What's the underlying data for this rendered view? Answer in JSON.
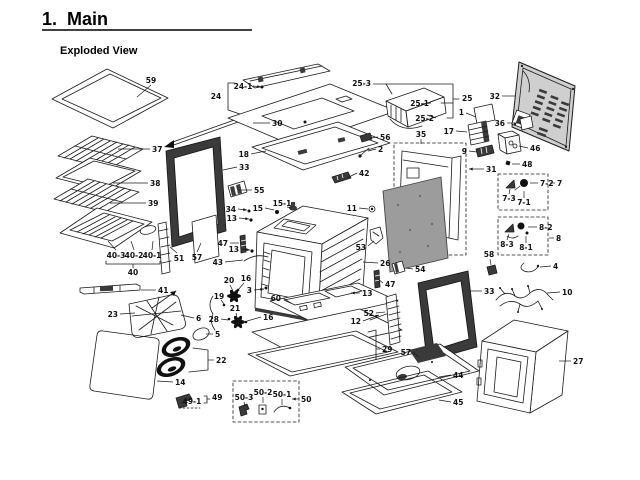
{
  "page": {
    "title": "1.  Main",
    "subtitle": "Exploded View"
  },
  "colors": {
    "ink": "#1a1a1a",
    "paper": "#ffffff",
    "panel_gray": "#cfcfcf",
    "insulation_gray": "#9c9c9c",
    "dark_fill": "#3a3a3a"
  },
  "diagram": {
    "labels": [
      {
        "t": "59",
        "x": 151,
        "y": 83,
        "a": "m",
        "line": [
          151,
          85,
          137,
          97
        ]
      },
      {
        "t": "37",
        "x": 152,
        "y": 152,
        "a": "s",
        "line": [
          150,
          149,
          118,
          149
        ]
      },
      {
        "t": "38",
        "x": 150,
        "y": 186,
        "a": "s",
        "line": [
          148,
          183,
          113,
          183
        ]
      },
      {
        "t": "39",
        "x": 148,
        "y": 206,
        "a": "s",
        "line": [
          146,
          203,
          110,
          203
        ]
      },
      {
        "t": "40-3",
        "x": 116,
        "y": 258,
        "a": "m",
        "line": [
          116,
          250,
          108,
          241
        ]
      },
      {
        "t": "40-2",
        "x": 134,
        "y": 258,
        "a": "m",
        "line": [
          134,
          250,
          131,
          241
        ]
      },
      {
        "t": "40-1",
        "x": 152,
        "y": 258,
        "a": "m",
        "line": [
          152,
          250,
          153,
          241
        ]
      },
      {
        "t": "40",
        "x": 133,
        "y": 275,
        "a": "m"
      },
      {
        "t": "51",
        "x": 179,
        "y": 261,
        "a": "m",
        "line": [
          177,
          253,
          170,
          247
        ]
      },
      {
        "t": "57",
        "x": 197,
        "y": 260,
        "a": "m",
        "line": [
          197,
          252,
          201,
          243
        ]
      },
      {
        "t": "41",
        "x": 158,
        "y": 293,
        "a": "s",
        "line": [
          156,
          290,
          141,
          290
        ]
      },
      {
        "t": "23",
        "x": 118,
        "y": 317,
        "a": "e",
        "line": [
          120,
          314,
          135,
          313
        ]
      },
      {
        "t": "6",
        "x": 196,
        "y": 321,
        "a": "s",
        "line": [
          194,
          318,
          181,
          315
        ]
      },
      {
        "t": "5",
        "x": 215,
        "y": 337,
        "a": "s",
        "line": [
          213,
          334,
          206,
          334
        ]
      },
      {
        "t": "22",
        "x": 216,
        "y": 363,
        "a": "s",
        "line": [
          214,
          360,
          208,
          360
        ]
      },
      {
        "t": "14",
        "x": 175,
        "y": 385,
        "a": "s",
        "line": [
          173,
          382,
          157,
          381
        ]
      },
      {
        "t": "49-1",
        "x": 192,
        "y": 404,
        "a": "m",
        "line": [
          186,
          400,
          181,
          404
        ]
      },
      {
        "t": "49",
        "x": 212,
        "y": 400,
        "a": "s"
      },
      {
        "t": "24-1",
        "x": 243,
        "y": 89,
        "a": "m",
        "line": [
          253,
          86,
          261,
          87
        ],
        "arrow": true
      },
      {
        "t": "24",
        "x": 216,
        "y": 99,
        "a": "m"
      },
      {
        "t": "30",
        "x": 272,
        "y": 126,
        "a": "s",
        "line": [
          270,
          123,
          253,
          123
        ]
      },
      {
        "t": "18",
        "x": 249,
        "y": 157,
        "a": "e",
        "line": [
          251,
          154,
          266,
          151
        ]
      },
      {
        "t": "33",
        "x": 239,
        "y": 170,
        "a": "s",
        "line": [
          237,
          167,
          223,
          170
        ]
      },
      {
        "t": "55",
        "x": 254,
        "y": 193,
        "a": "s",
        "line": [
          252,
          190,
          241,
          190
        ]
      },
      {
        "t": "34",
        "x": 236,
        "y": 212,
        "a": "e",
        "line": [
          238,
          209,
          247,
          210
        ],
        "arrow": true
      },
      {
        "t": "15",
        "x": 263,
        "y": 211,
        "a": "e",
        "line": [
          265,
          208,
          274,
          210
        ]
      },
      {
        "t": "15-1",
        "x": 282,
        "y": 206,
        "a": "m",
        "line": [
          287,
          207,
          292,
          208
        ]
      },
      {
        "t": "13",
        "x": 237,
        "y": 221,
        "a": "e",
        "line": [
          239,
          218,
          249,
          219
        ],
        "arrow": true
      },
      {
        "t": "47",
        "x": 228,
        "y": 246,
        "a": "e",
        "line": [
          230,
          243,
          239,
          243
        ]
      },
      {
        "t": "13",
        "x": 239,
        "y": 252,
        "a": "e",
        "line": [
          241,
          249,
          250,
          250
        ],
        "arrow": true
      },
      {
        "t": "43",
        "x": 223,
        "y": 265,
        "a": "e",
        "line": [
          225,
          262,
          243,
          260
        ]
      },
      {
        "t": "11",
        "x": 357,
        "y": 211,
        "a": "e",
        "line": [
          359,
          208,
          368,
          209
        ]
      },
      {
        "t": "53",
        "x": 366,
        "y": 250,
        "a": "e",
        "line": [
          368,
          246,
          374,
          241
        ]
      },
      {
        "t": "26",
        "x": 380,
        "y": 266,
        "a": "s",
        "line": [
          378,
          263,
          363,
          262
        ]
      },
      {
        "t": "54",
        "x": 415,
        "y": 272,
        "a": "s",
        "line": [
          413,
          269,
          406,
          268
        ]
      },
      {
        "t": "47",
        "x": 385,
        "y": 287,
        "a": "s",
        "line": [
          383,
          283,
          378,
          279
        ]
      },
      {
        "t": "13",
        "x": 362,
        "y": 296,
        "a": "s",
        "line": [
          360,
          293,
          351,
          293
        ],
        "arrow": true
      },
      {
        "t": "3",
        "x": 252,
        "y": 293,
        "a": "e",
        "line": [
          254,
          290,
          264,
          289
        ],
        "arrow": true
      },
      {
        "t": "20",
        "x": 229,
        "y": 283,
        "a": "m",
        "line": [
          230,
          285,
          233,
          291
        ]
      },
      {
        "t": "16",
        "x": 246,
        "y": 281,
        "a": "m",
        "line": [
          244,
          283,
          238,
          290
        ]
      },
      {
        "t": "19",
        "x": 219,
        "y": 299,
        "a": "m",
        "line": [
          221,
          300,
          224,
          304
        ]
      },
      {
        "t": "28",
        "x": 219,
        "y": 322,
        "a": "e",
        "line": [
          221,
          319,
          228,
          320
        ]
      },
      {
        "t": "21",
        "x": 235,
        "y": 311,
        "a": "m",
        "line": [
          236,
          313,
          237,
          318
        ]
      },
      {
        "t": "16",
        "x": 263,
        "y": 320,
        "a": "s",
        "line": [
          261,
          317,
          247,
          321
        ]
      },
      {
        "t": "60",
        "x": 281,
        "y": 301,
        "a": "e",
        "line": [
          283,
          298,
          291,
          303
        ]
      },
      {
        "t": "52",
        "x": 374,
        "y": 316,
        "a": "e",
        "line": [
          376,
          313,
          385,
          312
        ]
      },
      {
        "t": "12",
        "x": 361,
        "y": 324,
        "a": "e",
        "line": [
          363,
          321,
          379,
          315
        ],
        "arrow": true
      },
      {
        "t": "29",
        "x": 382,
        "y": 352,
        "a": "s",
        "line": [
          380,
          349,
          376,
          349
        ]
      },
      {
        "t": "50-3",
        "x": 244,
        "y": 400,
        "a": "m",
        "line": [
          244,
          402,
          245,
          406
        ]
      },
      {
        "t": "50-2",
        "x": 263,
        "y": 395,
        "a": "m",
        "line": [
          263,
          397,
          263,
          403
        ]
      },
      {
        "t": "50-1",
        "x": 282,
        "y": 397,
        "a": "m",
        "line": [
          282,
          399,
          282,
          405
        ]
      },
      {
        "t": "50",
        "x": 301,
        "y": 402,
        "a": "s",
        "line": [
          299,
          399,
          292,
          399
        ],
        "arrow": true
      },
      {
        "t": "42",
        "x": 359,
        "y": 176,
        "a": "s",
        "line": [
          357,
          173,
          347,
          178
        ]
      },
      {
        "t": "56",
        "x": 380,
        "y": 140,
        "a": "s",
        "line": [
          378,
          137,
          370,
          138
        ]
      },
      {
        "t": "2",
        "x": 378,
        "y": 152,
        "a": "s",
        "line": [
          376,
          149,
          368,
          151
        ]
      },
      {
        "t": "25-3",
        "x": 371,
        "y": 86,
        "a": "e",
        "line": [
          373,
          84,
          386,
          84
        ]
      },
      {
        "t": "25-1",
        "x": 429,
        "y": 106,
        "a": "e",
        "line": [
          431,
          103,
          421,
          104
        ]
      },
      {
        "t": "25",
        "x": 462,
        "y": 101,
        "a": "s"
      },
      {
        "t": "25-2",
        "x": 434,
        "y": 121,
        "a": "e",
        "line": [
          436,
          118,
          427,
          115
        ]
      },
      {
        "t": "1",
        "x": 464,
        "y": 115,
        "a": "e",
        "line": [
          466,
          113,
          476,
          117
        ]
      },
      {
        "t": "17",
        "x": 454,
        "y": 134,
        "a": "e",
        "line": [
          456,
          131,
          467,
          132
        ]
      },
      {
        "t": "9",
        "x": 467,
        "y": 154,
        "a": "e",
        "line": [
          469,
          151,
          477,
          152
        ]
      },
      {
        "t": "31",
        "x": 486,
        "y": 172,
        "a": "s",
        "line": [
          484,
          169,
          469,
          169
        ],
        "arrow": true
      },
      {
        "t": "35",
        "x": 421,
        "y": 137,
        "a": "m",
        "line": [
          421,
          139,
          421,
          144
        ]
      },
      {
        "t": "32",
        "x": 500,
        "y": 99,
        "a": "e",
        "line": [
          502,
          96,
          515,
          96
        ]
      },
      {
        "t": "36",
        "x": 505,
        "y": 126,
        "a": "e",
        "line": [
          507,
          123,
          518,
          123
        ]
      },
      {
        "t": "46",
        "x": 530,
        "y": 151,
        "a": "s",
        "line": [
          528,
          148,
          519,
          146
        ]
      },
      {
        "t": "48",
        "x": 522,
        "y": 167,
        "a": "s",
        "line": [
          520,
          164,
          512,
          164
        ]
      },
      {
        "t": "7-2",
        "x": 540,
        "y": 186,
        "a": "s",
        "line": [
          538,
          183,
          530,
          183
        ]
      },
      {
        "t": "7",
        "x": 557,
        "y": 186,
        "a": "s",
        "line": [
          555,
          183,
          550,
          183
        ]
      },
      {
        "t": "7-3",
        "x": 509,
        "y": 201,
        "a": "m",
        "line": [
          509,
          194,
          510,
          189
        ]
      },
      {
        "t": "7-1",
        "x": 524,
        "y": 205,
        "a": "m",
        "line": [
          524,
          198,
          524,
          191
        ]
      },
      {
        "t": "8-2",
        "x": 539,
        "y": 230,
        "a": "s",
        "line": [
          537,
          227,
          528,
          227
        ]
      },
      {
        "t": "8-3",
        "x": 507,
        "y": 247,
        "a": "m",
        "line": [
          507,
          240,
          509,
          234
        ]
      },
      {
        "t": "8-1",
        "x": 526,
        "y": 250,
        "a": "m",
        "line": [
          526,
          243,
          526,
          236
        ]
      },
      {
        "t": "8",
        "x": 556,
        "y": 241,
        "a": "s",
        "line": [
          554,
          238,
          549,
          238
        ]
      },
      {
        "t": "4",
        "x": 553,
        "y": 269,
        "a": "s",
        "line": [
          551,
          266,
          540,
          267
        ]
      },
      {
        "t": "10",
        "x": 562,
        "y": 295,
        "a": "s",
        "line": [
          560,
          292,
          547,
          293
        ]
      },
      {
        "t": "58",
        "x": 489,
        "y": 257,
        "a": "m",
        "line": [
          490,
          259,
          491,
          265
        ]
      },
      {
        "t": "33",
        "x": 484,
        "y": 294,
        "a": "s",
        "line": [
          482,
          291,
          469,
          291
        ]
      },
      {
        "t": "57",
        "x": 411,
        "y": 355,
        "a": "e",
        "line": [
          413,
          352,
          419,
          357
        ]
      },
      {
        "t": "44",
        "x": 453,
        "y": 378,
        "a": "s",
        "line": [
          451,
          375,
          439,
          377
        ]
      },
      {
        "t": "45",
        "x": 453,
        "y": 405,
        "a": "s",
        "line": [
          451,
          402,
          439,
          400
        ]
      },
      {
        "t": "27",
        "x": 573,
        "y": 364,
        "a": "s",
        "line": [
          571,
          361,
          559,
          361
        ]
      }
    ]
  }
}
